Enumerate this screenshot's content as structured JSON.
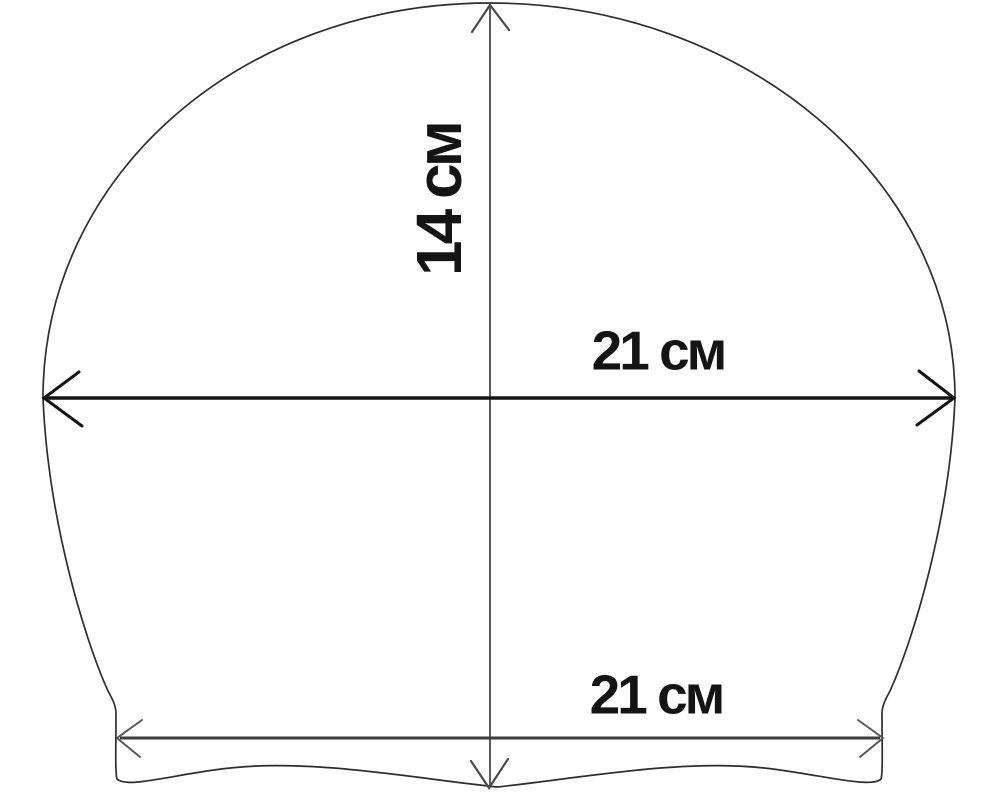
{
  "diagram": {
    "type": "dimension-drawing",
    "subject": "swim-cap-outline",
    "dimensions": {
      "height": {
        "label": "14 см",
        "orientation": "vertical"
      },
      "width": {
        "label": "21 см",
        "orientation": "horizontal"
      },
      "base_width": {
        "label": "21 см",
        "orientation": "horizontal"
      }
    }
  },
  "colors": {
    "background": "#ffffff",
    "ink": "#141414",
    "outline": "#2e2e2e",
    "width_line": "#141414",
    "base_line": "#3d3d3d",
    "height_line": "#4a4a4a",
    "arrow_gray": "#555555"
  }
}
